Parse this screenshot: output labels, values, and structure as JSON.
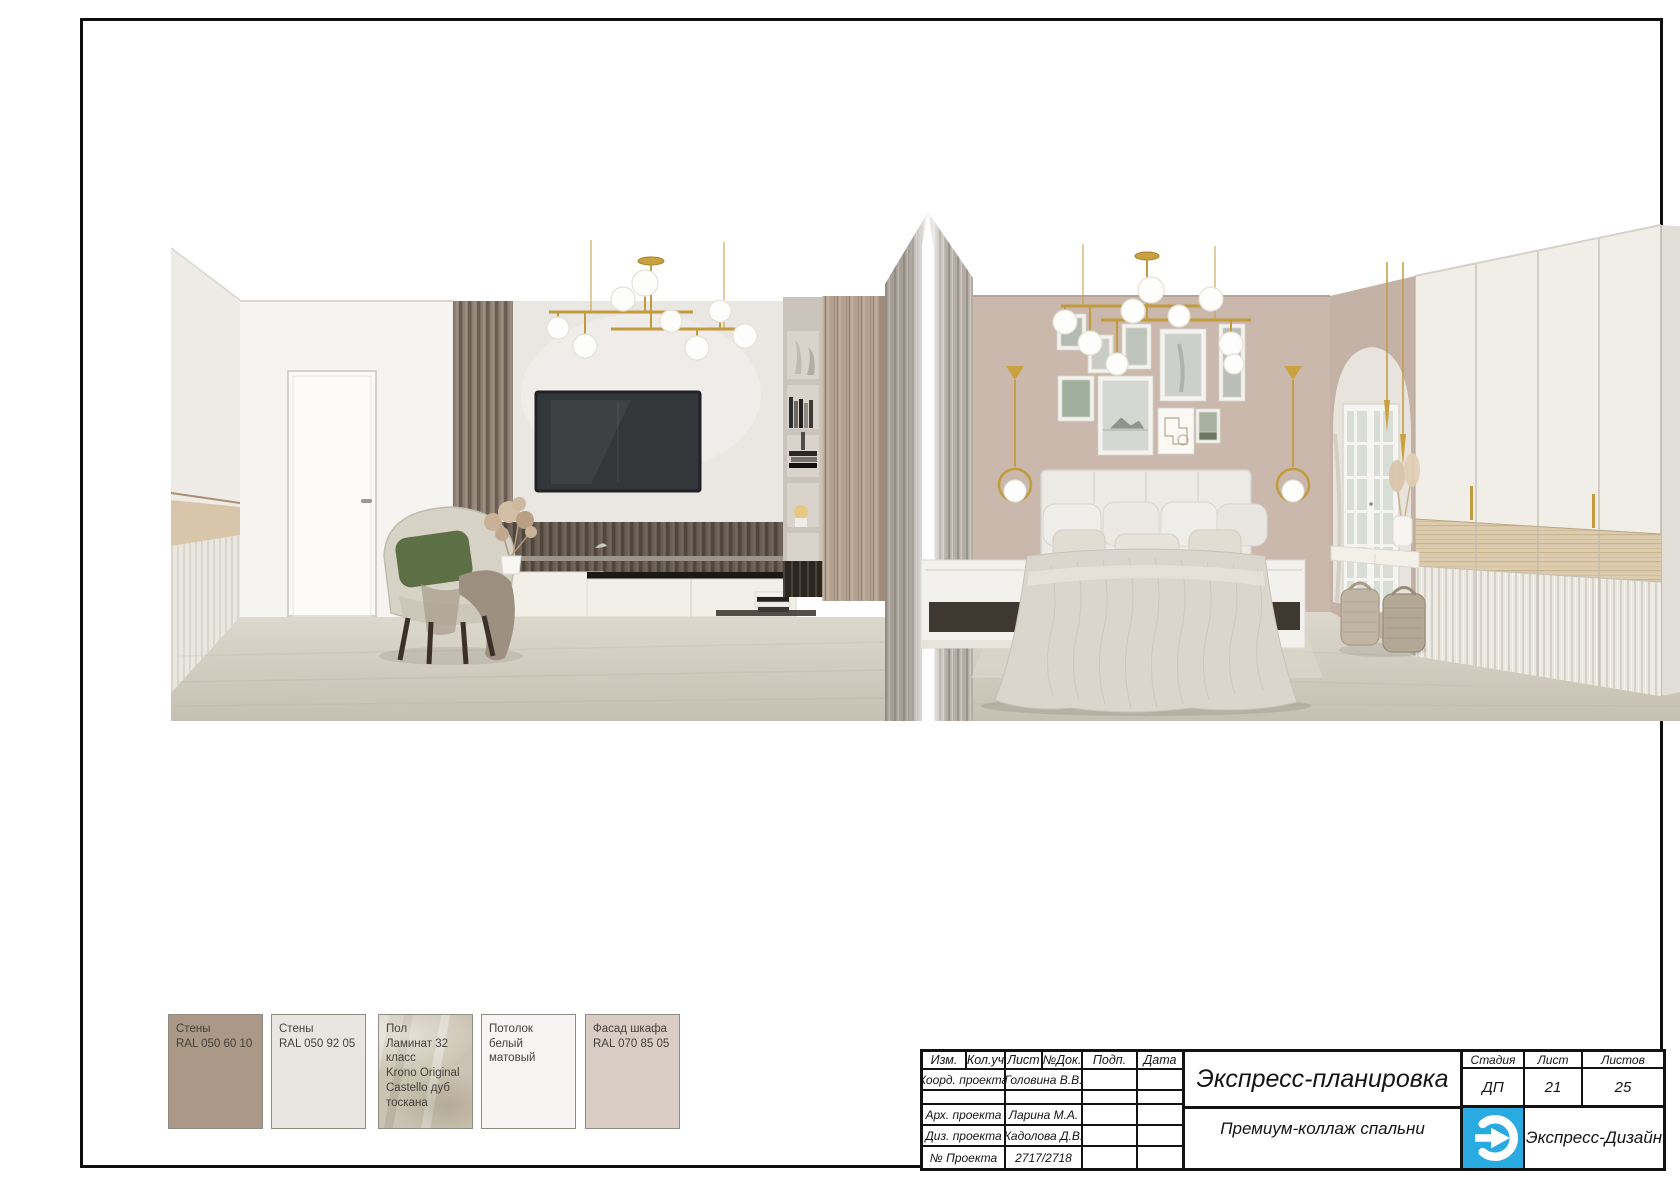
{
  "stamp": {
    "cols": [
      "Изм.",
      "Кол.уч",
      "Лист",
      "№Док.",
      "Подп.",
      "Дата"
    ],
    "rows": [
      {
        "role": "Коорд. проекта",
        "value": "Головина В.В."
      },
      {
        "role": "",
        "value": ""
      },
      {
        "role": "Арх. проекта",
        "value": "Ларина М.А."
      },
      {
        "role": "Диз. проекта",
        "value": "Кадолова Д.В."
      },
      {
        "role": "№ Проекта",
        "value": "2717/2718"
      }
    ],
    "project_title": "Экспресс-планировка",
    "sheet_title": "Премиум-коллаж спальни",
    "stage": {
      "label": "Стадия",
      "value": "ДП"
    },
    "sheet": {
      "label": "Лист",
      "value": "21"
    },
    "total": {
      "label": "Листов",
      "value": "25"
    },
    "company": "Экспресс-Дизайн",
    "logo_color": "#29abe2"
  },
  "swatches": [
    {
      "name": "Стены",
      "spec": "RAL 050 60 10",
      "color": "#ab9886"
    },
    {
      "name": "Стены",
      "spec": "RAL 050 92 05",
      "color": "#e9e6e1"
    },
    {
      "name": "Пол",
      "spec": "Ламинат 32 класс\nKrono Original\nCastello дуб\nтоскана",
      "color": "#ccc4b2"
    },
    {
      "name": "Потолок",
      "spec": "белый матовый",
      "color": "#f6f5f3"
    },
    {
      "name": "Фасад шкафа",
      "spec": "RAL 070 85 05",
      "color": "#d9cdc5"
    }
  ]
}
